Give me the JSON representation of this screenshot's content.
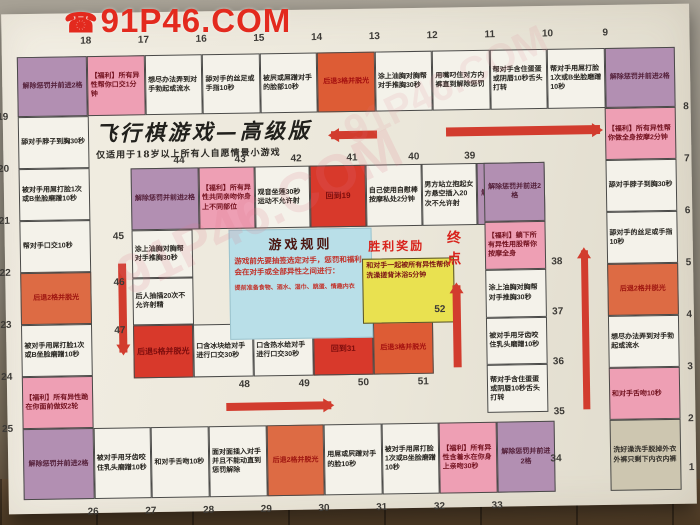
{
  "watermark": {
    "text": "91P46.COM",
    "phone_icon": "☎"
  },
  "board": {
    "title": "飞行棋游戏—高级版",
    "subtitle": "仅适用于18岁以上所有人自愿情景小游戏",
    "rules": {
      "title": "游戏规则",
      "body": "游戏前先要抽签选定对手，惩罚和福利会在对手或全部异性之间进行：",
      "note": "提前准备食物、酒水、湿巾、跳蛋、情趣内衣"
    },
    "victory": {
      "title": "胜利奖励",
      "text": "和对手一起被所有异性帮你洗澡搓背沐浴5分钟"
    },
    "finish_label": "终点",
    "colors": {
      "corner_purple": "#b28fb2",
      "welfare_pink": "#ee9fb4",
      "penalty_orange": "#dd6b44",
      "goto_red": "#d8392b",
      "plain": "#f4f2ea",
      "start_tan": "#cdc6b0",
      "rules_blue": "#b9dfe8",
      "victory_yellow": "#e9e150",
      "arrow_red": "#d23c2e"
    },
    "rings": {
      "outer_top": [
        {
          "n": 18,
          "t": "解除惩罚并前进2格",
          "c": "purple",
          "corner": true
        },
        {
          "n": 17,
          "t": "【福利】所有异性帮你口交1分钟",
          "c": "pink"
        },
        {
          "n": 16,
          "t": "想尽办法弄到对手勃起或流水",
          "c": "white"
        },
        {
          "n": 15,
          "t": "舔对手的丝足或手指10秒",
          "c": "white"
        },
        {
          "n": 14,
          "t": "被屄或屌蹭对手的脸部10秒",
          "c": "white"
        },
        {
          "n": 13,
          "t": "后退3格并脱光",
          "c": "orange2"
        },
        {
          "n": 12,
          "t": "涂上油胸对胸帮对手推胸30秒",
          "c": "white"
        },
        {
          "n": 11,
          "t": "用嘴叼住对方内裤直到解除惩罚",
          "c": "white"
        },
        {
          "n": 10,
          "t": "帮对手含住蛋蛋或阴唇10秒舌头打转",
          "c": "white"
        },
        {
          "n": 9,
          "t": "帮对手用屌打脸1次或B坐脸磨蹭10秒",
          "c": "white"
        },
        {
          "n": 8,
          "t": "解除惩罚并前进2格",
          "c": "purple",
          "corner": true
        }
      ],
      "outer_left": [
        {
          "n": 19,
          "t": "舔对手脖子到胸30秒",
          "c": "white"
        },
        {
          "n": 20,
          "t": "被对手用屌打脸1次或B坐脸磨蹭10秒",
          "c": "white"
        },
        {
          "n": 21,
          "t": "帮对手口交10秒",
          "c": "white"
        },
        {
          "n": 22,
          "t": "后退2格并脱光",
          "c": "orange"
        },
        {
          "n": 23,
          "t": "被对手用屌打脸1次或B坐脸磨蹭10秒",
          "c": "white"
        },
        {
          "n": 24,
          "t": "【福利】所有异性跪在你面前做奴2轮",
          "c": "pink"
        }
      ],
      "outer_right": [
        {
          "n": 7,
          "t": "【福利】所有异性帮你做全身按摩2分钟",
          "c": "pink"
        },
        {
          "n": 6,
          "t": "舔对手脖子到胸30秒",
          "c": "white"
        },
        {
          "n": 5,
          "t": "舔对手的丝足或手指10秒",
          "c": "white"
        },
        {
          "n": 4,
          "t": "后退2格并脱光",
          "c": "orange"
        },
        {
          "n": 3,
          "t": "想尽办法弄到对手勃起或流水",
          "c": "white"
        },
        {
          "n": 2,
          "t": "和对手舌吻10秒",
          "c": "pink"
        }
      ],
      "outer_bottom": [
        {
          "n": 25,
          "t": "解除惩罚并前进2格",
          "c": "purple",
          "corner": true
        },
        {
          "n": 26,
          "t": "被对手用牙齿咬住乳头磨蹭10秒",
          "c": "white"
        },
        {
          "n": 27,
          "t": "和对手舌吻10秒",
          "c": "white"
        },
        {
          "n": 28,
          "t": "面对面插入对手并且不能动直到惩罚解除",
          "c": "white"
        },
        {
          "n": 29,
          "t": "后退2格并脱光",
          "c": "orange"
        },
        {
          "n": 30,
          "t": "用屌或屄蹭对手的脸10秒",
          "c": "white"
        },
        {
          "n": 31,
          "t": "被对手用屌打脸1次或B坐脸磨蹭10秒",
          "c": "white"
        },
        {
          "n": 32,
          "t": "【福利】所有异性含着水在你身上亲吻30秒",
          "c": "pink"
        },
        {
          "n": 33,
          "t": "解除惩罚并前进2格",
          "c": "purple"
        },
        {
          "n": null,
          "t": "",
          "c": "gap"
        },
        {
          "n": 1,
          "t": "洗好澡洗手脱掉外衣外裤只剩下内衣内裤",
          "c": "tan",
          "corner": true
        }
      ],
      "inner_top": [
        {
          "n": 44,
          "t": "解除惩罚并前进2格",
          "c": "purple",
          "corner": true
        },
        {
          "n": 43,
          "t": "【福利】所有异性共同亲吻你身上不同部位",
          "c": "pink"
        },
        {
          "n": 42,
          "t": "观音坐莲30秒运动不允许射",
          "c": "white"
        },
        {
          "n": 41,
          "t": "回到19",
          "c": "red"
        },
        {
          "n": 40,
          "t": "自己使用自慰棒按摩私处2分钟",
          "c": "white"
        },
        {
          "n": 39,
          "t": "男方站立抱起女方悬空插入20次不允许射",
          "c": "white"
        },
        {
          "n": null,
          "t": "解除惩罚并前进2格",
          "c": "purple",
          "corner": true
        }
      ],
      "inner_left": [
        {
          "n": 45,
          "t": "涂上油胸对胸帮对手推胸30秒",
          "c": "white"
        },
        {
          "n": 46,
          "t": "后人抽插20次不允许射精",
          "c": "white"
        }
      ],
      "inner_bottom": [
        {
          "n": 47,
          "t": "后退5格并脱光",
          "c": "red"
        },
        {
          "n": 48,
          "t": "口含冰块给对手进行口交30秒",
          "c": "white"
        },
        {
          "n": 49,
          "t": "口含热水给对手进行口交30秒",
          "c": "white"
        },
        {
          "n": 50,
          "t": "回到31",
          "c": "red"
        },
        {
          "n": 51,
          "t": "后退3格并脱光",
          "c": "orange2"
        }
      ],
      "inner_right": [
        {
          "n": null,
          "t": "解除惩罚并前进2格",
          "c": "purple",
          "corner": true
        },
        {
          "n": 38,
          "t": "【福利】躺下所有异性用股帮你按摩全身",
          "c": "pink"
        },
        {
          "n": 37,
          "t": "涂上油胸对胸帮对手推胸30秒",
          "c": "white"
        },
        {
          "n": 36,
          "t": "被对手用牙齿咬住乳头磨蹭10秒",
          "c": "white"
        },
        {
          "n": 35,
          "t": "帮对手含住蛋蛋或阴唇10秒舌头打转",
          "c": "white"
        }
      ]
    },
    "numbers": {
      "top": [
        18,
        17,
        16,
        15,
        14,
        13,
        12,
        11,
        10,
        9
      ],
      "left": [
        19,
        20,
        21,
        22,
        23,
        24,
        25
      ],
      "right": [
        8,
        7,
        6,
        5,
        4,
        3,
        2
      ],
      "bottom": [
        26,
        27,
        28,
        29,
        30,
        31,
        32,
        33
      ],
      "inner_top": [
        44,
        43,
        42,
        41,
        40,
        39
      ],
      "inner_left": [
        45,
        46,
        47
      ],
      "inner_bottom": [
        48,
        49,
        50,
        51
      ],
      "inner_right": [
        38,
        37,
        36,
        35
      ],
      "special": [
        1,
        34,
        52
      ]
    }
  }
}
